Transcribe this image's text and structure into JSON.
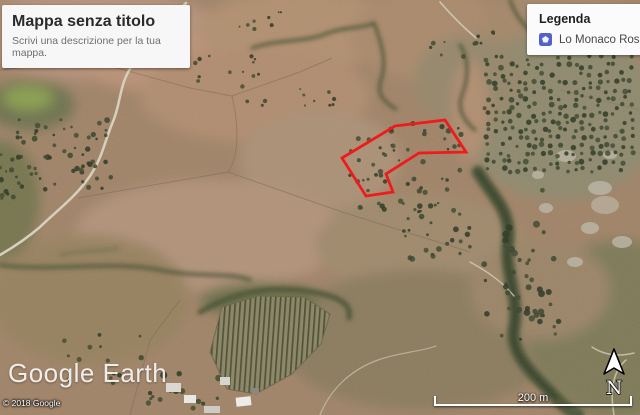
{
  "title_card": {
    "title": "Mappa senza titolo",
    "subtitle": "Scrivi una descrizione per la tua mappa."
  },
  "legend": {
    "title": "Legenda",
    "items": [
      {
        "label": "Lo Monaco Rosa",
        "icon": "polygon-layer-icon",
        "icon_color": "#5560c9"
      }
    ]
  },
  "branding": {
    "watermark": "Google Earth",
    "copyright": "© 2018 Google"
  },
  "scale_bar": {
    "label": "200 m"
  },
  "north_indicator": {
    "label": "N"
  },
  "overlay_shape": {
    "name": "Lo Monaco Rosa",
    "stroke_color": "#ef1b1b",
    "points": "395,126 445,120 466,152 419,153 386,174 393,192 366,196 342,158"
  }
}
